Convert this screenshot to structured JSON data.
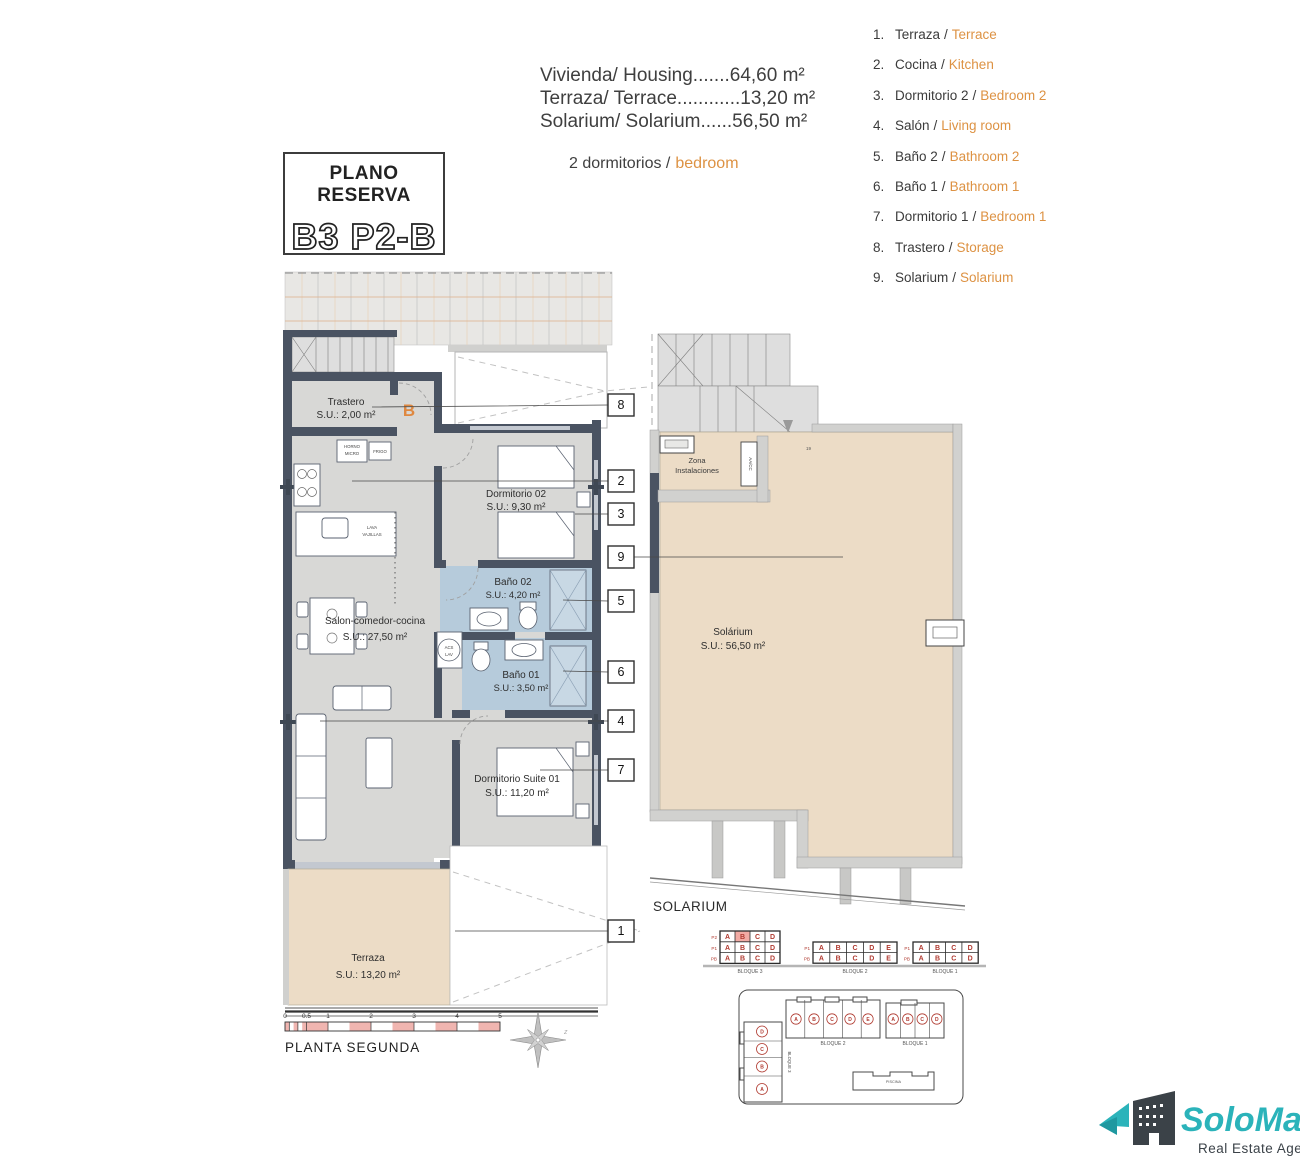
{
  "header": {
    "plano_reserva": {
      "title": "PLANO RESERVA",
      "code": "B3 P2-B"
    },
    "areas": [
      "Vivienda/ Housing.......64,60 m²",
      "Terraza/ Terrace............13,20 m²",
      "Solarium/ Solarium......56,50 m²"
    ],
    "bedrooms_es": "2 dormitorios /",
    "bedrooms_en": "bedroom"
  },
  "legend": {
    "sep": "/",
    "items": [
      {
        "num": "1.",
        "es": "Terraza",
        "en": "Terrace"
      },
      {
        "num": "2.",
        "es": "Cocina",
        "en": "Kitchen"
      },
      {
        "num": "3.",
        "es": "Dormitorio 2",
        "en": "Bedroom 2"
      },
      {
        "num": "4.",
        "es": "Salón",
        "en": "Living room"
      },
      {
        "num": "5.",
        "es": "Baño 2",
        "en": "Bathroom 2"
      },
      {
        "num": "6.",
        "es": "Baño 1",
        "en": "Bathroom 1"
      },
      {
        "num": "7.",
        "es": "Dormitorio 1",
        "en": "Bedroom 1"
      },
      {
        "num": "8.",
        "es": "Trastero",
        "en": "Storage"
      },
      {
        "num": "9.",
        "es": "Solarium",
        "en": "Solarium"
      }
    ]
  },
  "plan": {
    "unit_letter": "B",
    "rooms": {
      "trastero": {
        "name": "Trastero",
        "area": "S.U.: 2,00 m²"
      },
      "dorm2": {
        "name": "Dormitorio 02",
        "area": "S.U.: 9,30 m²"
      },
      "bano2": {
        "name": "Baño 02",
        "area": "S.U.: 4,20 m²"
      },
      "bano1": {
        "name": "Baño 01",
        "area": "S.U.: 3,50 m²"
      },
      "salon": {
        "name": "Salon-comedor-cocina",
        "area": "S.U.: 27,50 m²"
      },
      "suite": {
        "name": "Dormitorio Suite 01",
        "area": "S.U.: 11,20 m²"
      },
      "terraza": {
        "name": "Terraza",
        "area": "S.U.: 13,20 m²"
      }
    },
    "fixtures": {
      "horno1": "HORNO",
      "horno2": "MICRO",
      "frigo": "FRIGO",
      "lava1": "LAVA",
      "lava2": "VAJILLAS",
      "acs1": "ACS",
      "acs2": "LAV"
    },
    "callouts": [
      "8",
      "2",
      "3",
      "9",
      "5",
      "6",
      "4",
      "7",
      "1"
    ]
  },
  "solarium": {
    "name": "Solárium",
    "area": "S.U.: 56,50 m²",
    "zona1": "Zona",
    "zona2": "Instalaciones",
    "aacc": "AA/CC",
    "step": "19",
    "caption": "SOLARIUM"
  },
  "blocks": [
    {
      "caption": "BLOQUE 3",
      "rows": [
        {
          "label": "P2",
          "cells": [
            "A",
            "B",
            "C",
            "D"
          ]
        },
        {
          "label": "P1",
          "cells": [
            "A",
            "B",
            "C",
            "D"
          ]
        },
        {
          "label": "PB",
          "cells": [
            "A",
            "B",
            "C",
            "D"
          ]
        }
      ]
    },
    {
      "caption": "BLOQUE 2",
      "rows": [
        {
          "label": "P1",
          "cells": [
            "A",
            "B",
            "C",
            "D",
            "E"
          ]
        },
        {
          "label": "PB",
          "cells": [
            "A",
            "B",
            "C",
            "D",
            "E"
          ]
        }
      ]
    },
    {
      "caption": "BLOQUE 1",
      "rows": [
        {
          "label": "P1",
          "cells": [
            "A",
            "B",
            "C",
            "D"
          ]
        },
        {
          "label": "PB",
          "cells": [
            "A",
            "B",
            "C",
            "D"
          ]
        }
      ]
    }
  ],
  "siteplan": {
    "bloque2": {
      "caption": "BLOQUE 2",
      "units": [
        "A",
        "B",
        "C",
        "D",
        "E"
      ]
    },
    "bloque1": {
      "caption": "BLOQUE 1",
      "units": [
        "A",
        "B",
        "C",
        "D"
      ]
    },
    "bloque3": {
      "caption": "BLOQUE 3",
      "units": [
        "D",
        "C",
        "B",
        "A"
      ]
    },
    "piscina": "PISCINA"
  },
  "scalebar": {
    "ticks": [
      "0",
      "0.5",
      "1",
      "2",
      "3",
      "4",
      "5"
    ]
  },
  "footer": {
    "floor_label": "PLANTA SEGUNDA",
    "compass_mark": "z"
  },
  "logo": {
    "name": "SoloMar",
    "tagline": "Real Estate Agency"
  },
  "colors": {
    "orange": "#DD9243",
    "red_letter": "#B03A30",
    "highlight_pink": "#F2ABA4",
    "wall": "#4A5362",
    "bath_blue": "#B6CBDB",
    "terrace_beige": "#ECDCC6",
    "teal": "#2BB3BA",
    "dark": "#3B4248"
  }
}
